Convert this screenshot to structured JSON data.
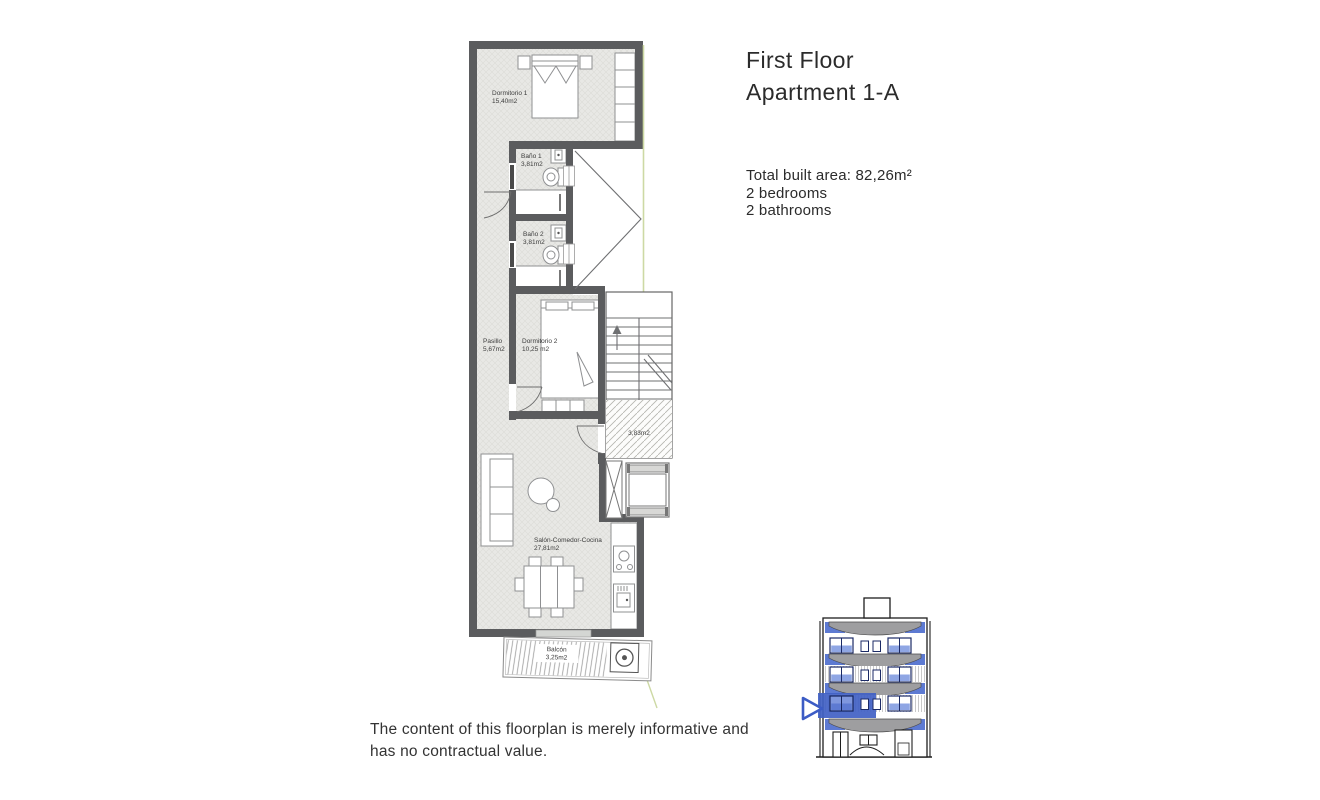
{
  "header": {
    "title_line1": "First Floor",
    "title_line2": "Apartment 1-A",
    "details": {
      "area": "Total built area: 82,26m²",
      "bedrooms": "2 bedrooms",
      "bathrooms": "2 bathrooms"
    }
  },
  "floorplan": {
    "rooms": [
      {
        "name": "Dormitorio 1",
        "area": "15,40m2"
      },
      {
        "name": "Baño 1",
        "area": "3,81m2"
      },
      {
        "name": "Baño 2",
        "area": "3,81m2"
      },
      {
        "name": "Pasillo",
        "area": "5,67m2"
      },
      {
        "name": "Dormitorio 2",
        "area": "10,25 m2"
      },
      {
        "name": "Salón-Comedor-Cocina",
        "area": "27,81m2"
      },
      {
        "name": "Balcón",
        "area": "3,25m2"
      }
    ],
    "landing_area": "3,83m2"
  },
  "footer": {
    "disclaimer": "The content of this floorplan is merely informative and has no contractual value."
  },
  "colors": {
    "wall": "#5b5c5e",
    "floor": "#e8e8e5",
    "boundary_green": "#cdd9a4",
    "accent_blue": "#4161c4",
    "window_glass_blue": "#8fa6e4",
    "balcony_gray": "#9e9ea0",
    "text": "#2b2b2b"
  }
}
